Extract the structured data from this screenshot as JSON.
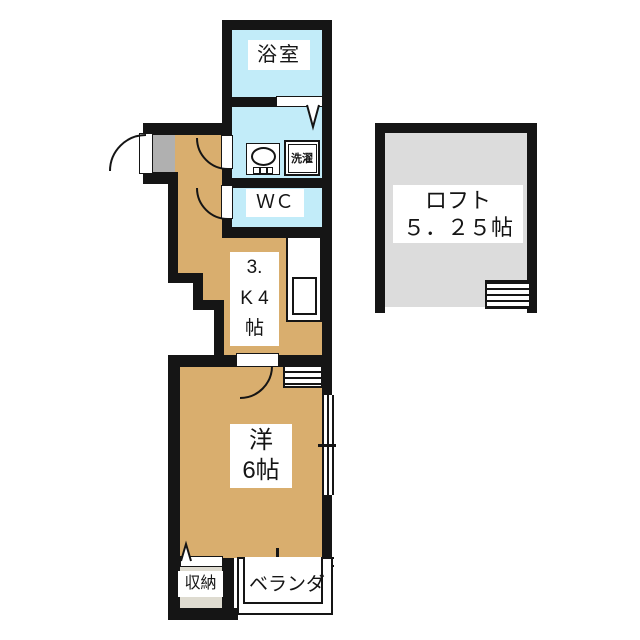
{
  "rooms": {
    "bathroom": {
      "label": "浴室"
    },
    "washroom": {
      "laundry_label": "洗濯"
    },
    "wc": {
      "label": "ＷＣ"
    },
    "kitchen": {
      "lines": [
        "3.",
        "K 4",
        "帖"
      ]
    },
    "western_room": {
      "lines": [
        "洋",
        "6帖"
      ]
    },
    "loft": {
      "lines": [
        "ロフト",
        "５．２５帖"
      ]
    },
    "storage": {
      "label": "収納"
    },
    "balcony": {
      "label": "ベランダ"
    }
  },
  "colors": {
    "wall_black": "#151515",
    "floor_tan": "#d9ae6e",
    "water_blue": "#c2ecf9",
    "loft_gray": "#dcdcdc",
    "genkan_gray": "#b0b0b0",
    "storage_gray": "#dedbd0"
  }
}
